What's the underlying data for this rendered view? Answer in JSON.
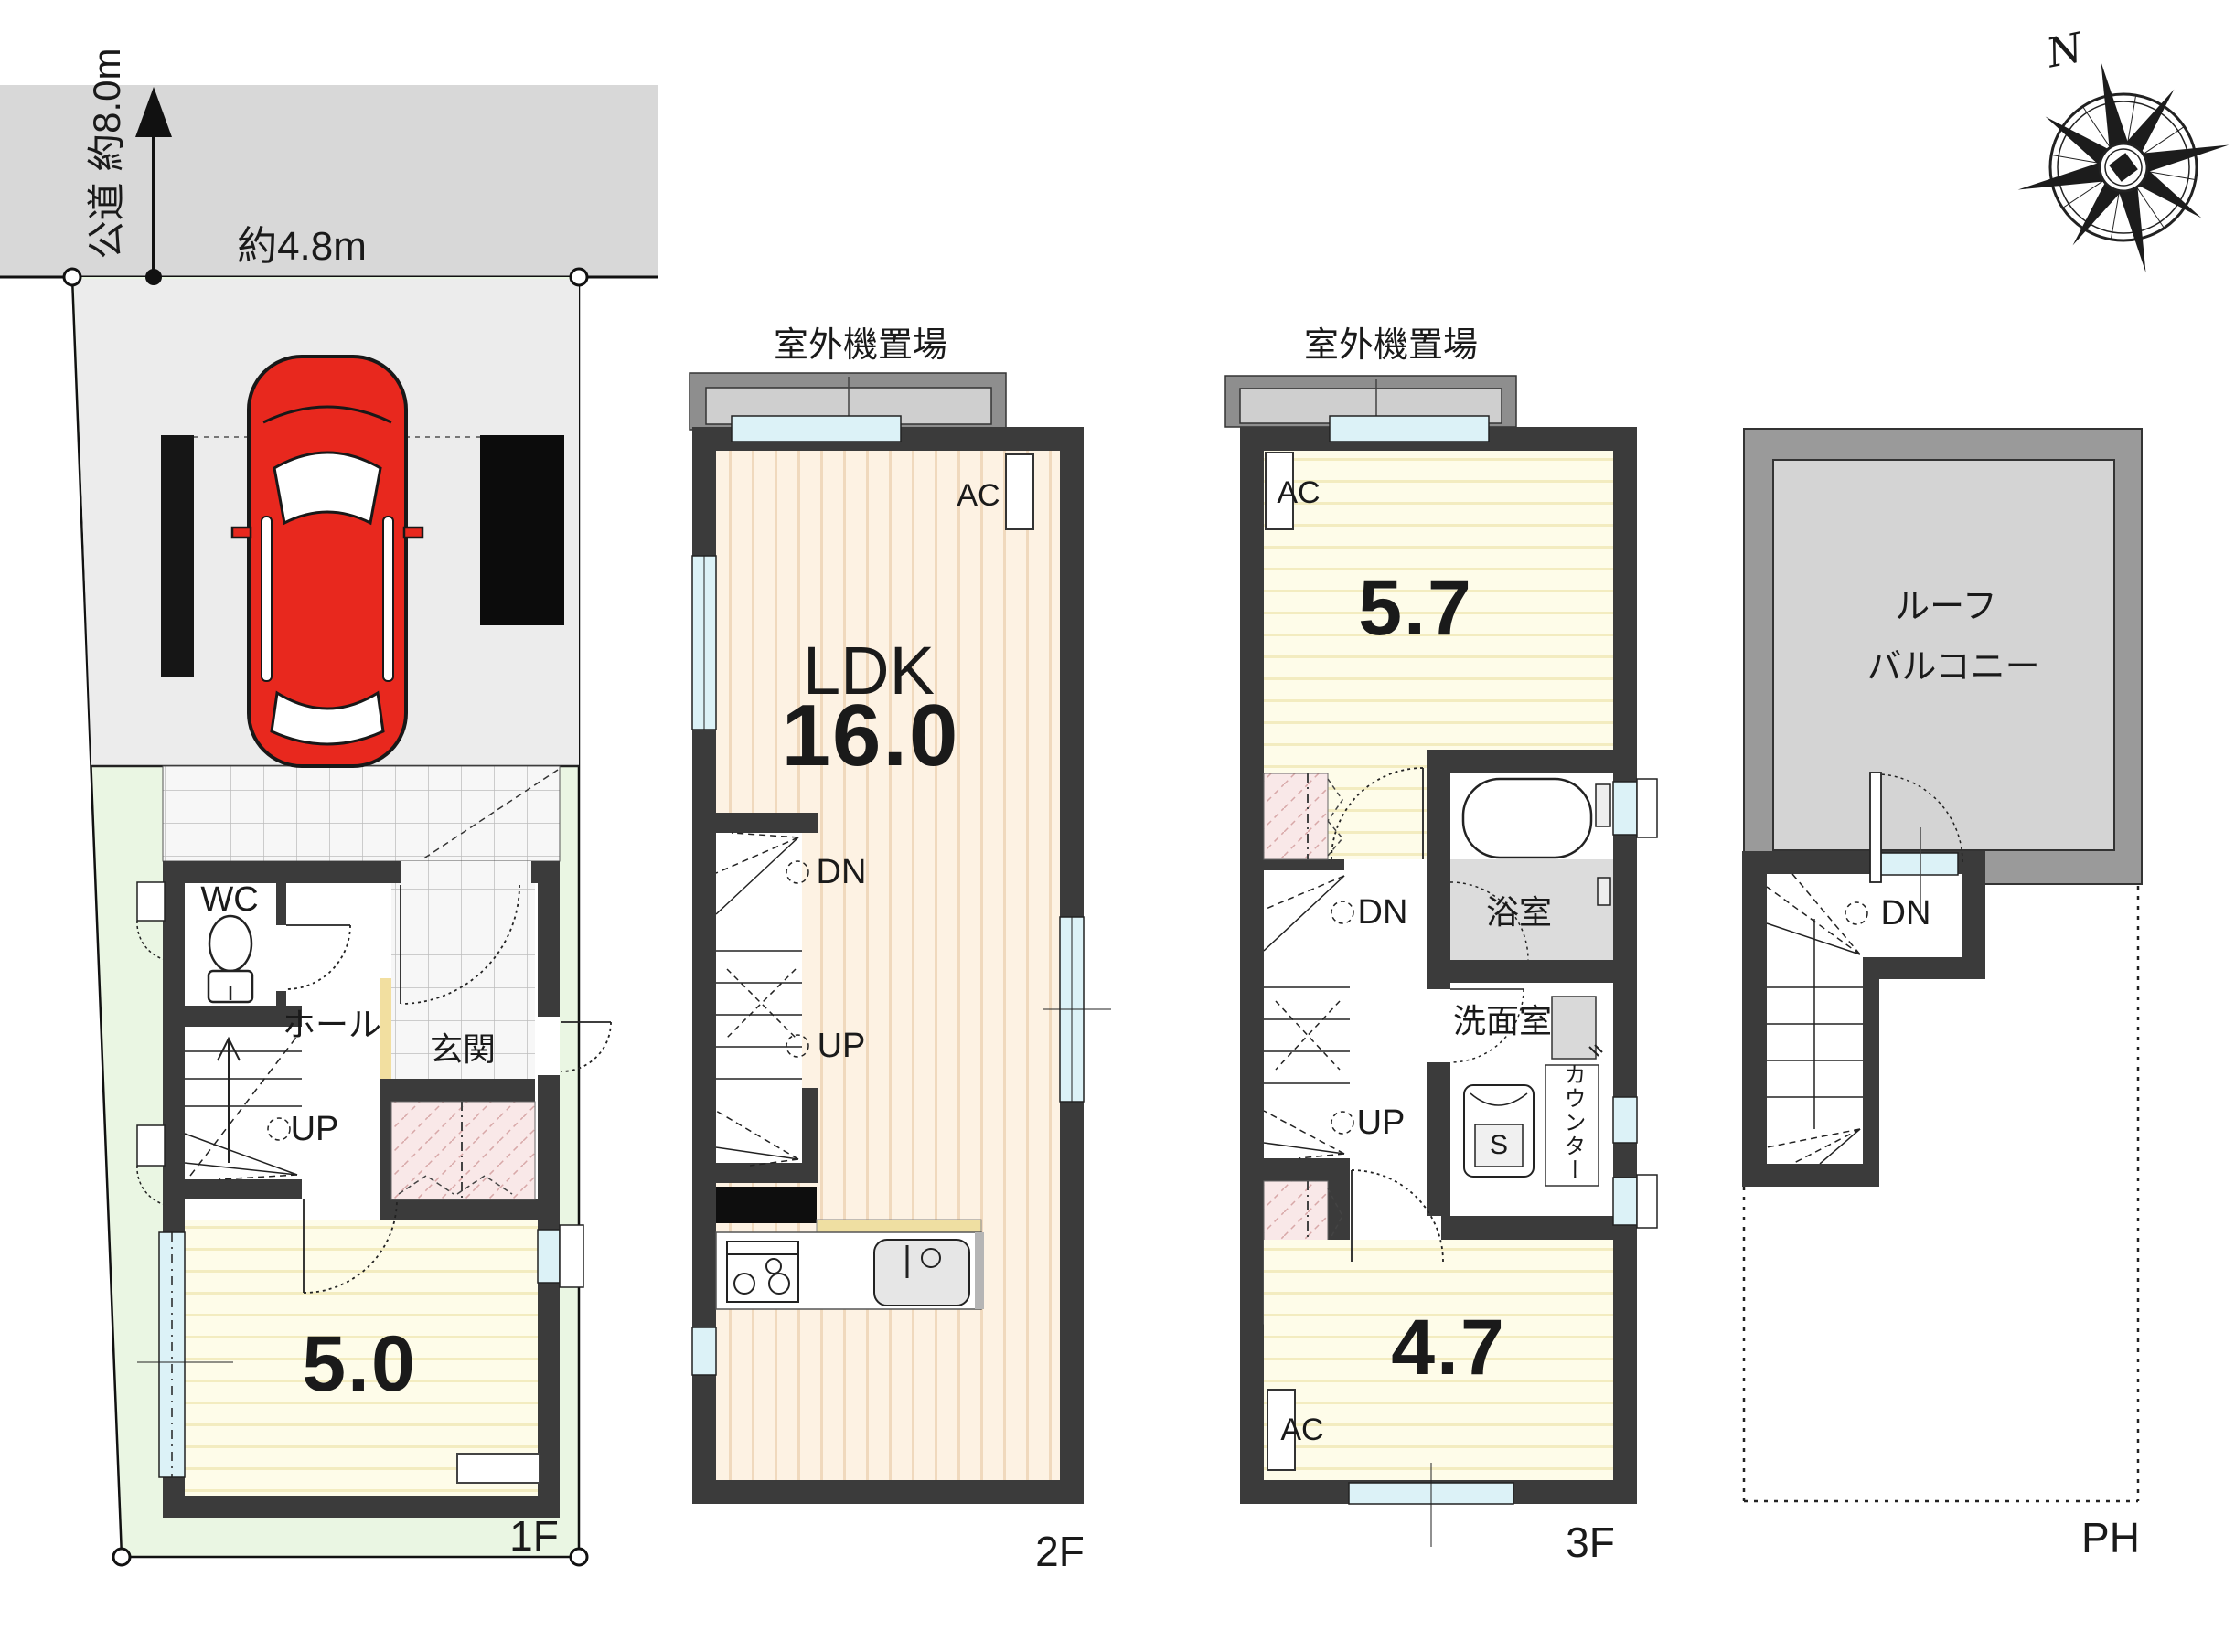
{
  "site": {
    "road_label": "公道 約8.0m",
    "width_label": "約4.8m",
    "compass_north": "N"
  },
  "floor1": {
    "name": "1F",
    "wc": "WC",
    "hall": "ホール",
    "entrance": "玄関",
    "room_size": "5.0",
    "up": "UP"
  },
  "floor2": {
    "name": "2F",
    "outdoor_unit": "室外機置場",
    "ldk": "LDK",
    "ldk_size": "16.0",
    "ac": "AC",
    "dn": "DN",
    "up": "UP"
  },
  "floor3": {
    "name": "3F",
    "outdoor_unit": "室外機置場",
    "room_a_size": "5.7",
    "room_b_size": "4.7",
    "bath": "浴室",
    "washroom": "洗面室",
    "counter": "カウンター",
    "washer": "S",
    "ac": "AC",
    "dn": "DN",
    "up": "UP"
  },
  "penthouse": {
    "name": "PH",
    "roof_balcony_line1": "ルーフ",
    "roof_balcony_line2": "バルコニー",
    "dn": "DN"
  },
  "colors": {
    "wall": "#3b3b3b",
    "road": "#d8d8d8",
    "lot": "#eaf6e3",
    "park": "#ececec",
    "win": "#dcf2f7",
    "balc-dark": "#8e8e8e",
    "balc-light": "#cfcfcf",
    "ph-frame": "#9a9a9a",
    "ph-inner": "#d4d4d4",
    "pink": "#f9e8e8",
    "bathfloor": "#dcdcdc",
    "car": "#e8281e",
    "step": "#f2dfa0"
  }
}
